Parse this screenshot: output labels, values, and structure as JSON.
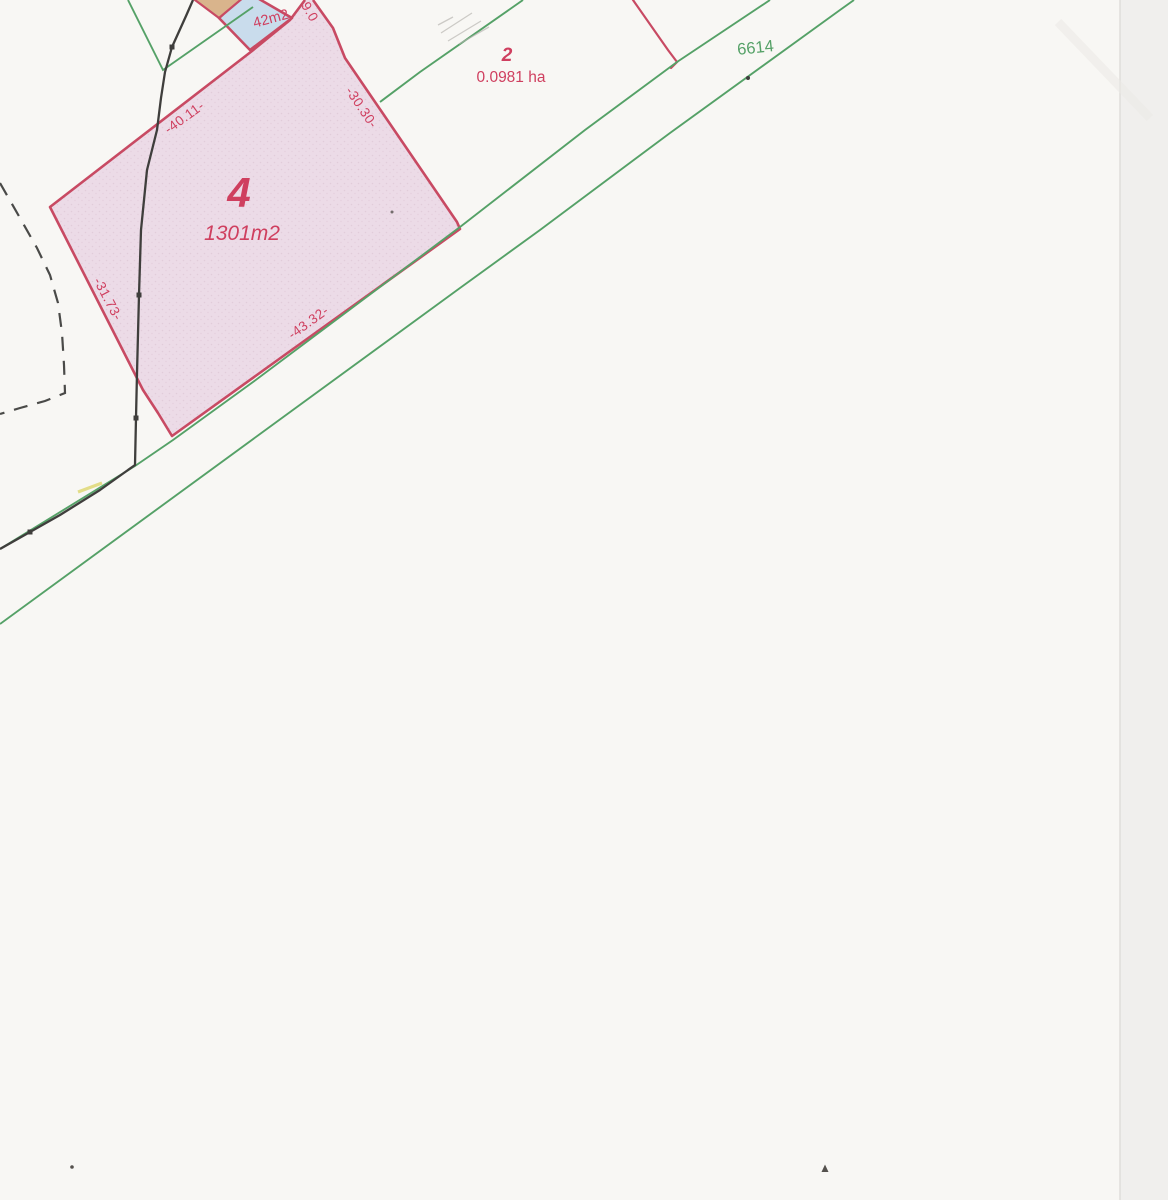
{
  "parcels": {
    "parcel4": {
      "number": "4",
      "area": "1301m2"
    },
    "parcel2": {
      "number": "2",
      "area": "0.0981 ha"
    },
    "parcel42": {
      "area": "42m2"
    },
    "road": {
      "number": "6614"
    }
  },
  "measurements": {
    "edge_nw": "-40.11-",
    "edge_ne": "-30.30-",
    "edge_sw": "-31.73-",
    "edge_se": "-43.32-",
    "edge_strip": "9.0"
  },
  "colors": {
    "paper": "#f8f7f4",
    "scanner_margin": "#f0efed",
    "scanner_edge_line": "#dcdbd7",
    "parcel_fill_pink": "#ecdbe7",
    "parcel_stipple": "#d9bed0",
    "parcel_fill_blue": "#c9dcec",
    "parcel_fill_tan": "#d9b48c",
    "boundary_red": "#c84a63",
    "label_red": "#cf3f5f",
    "line_green": "#55a167",
    "line_black": "#3f3e3c",
    "dash_black": "#4a4a48",
    "pencil_gray": "#b5b3ae",
    "highlight_yellow": "#ded76e",
    "speck_dark": "#55514d"
  }
}
